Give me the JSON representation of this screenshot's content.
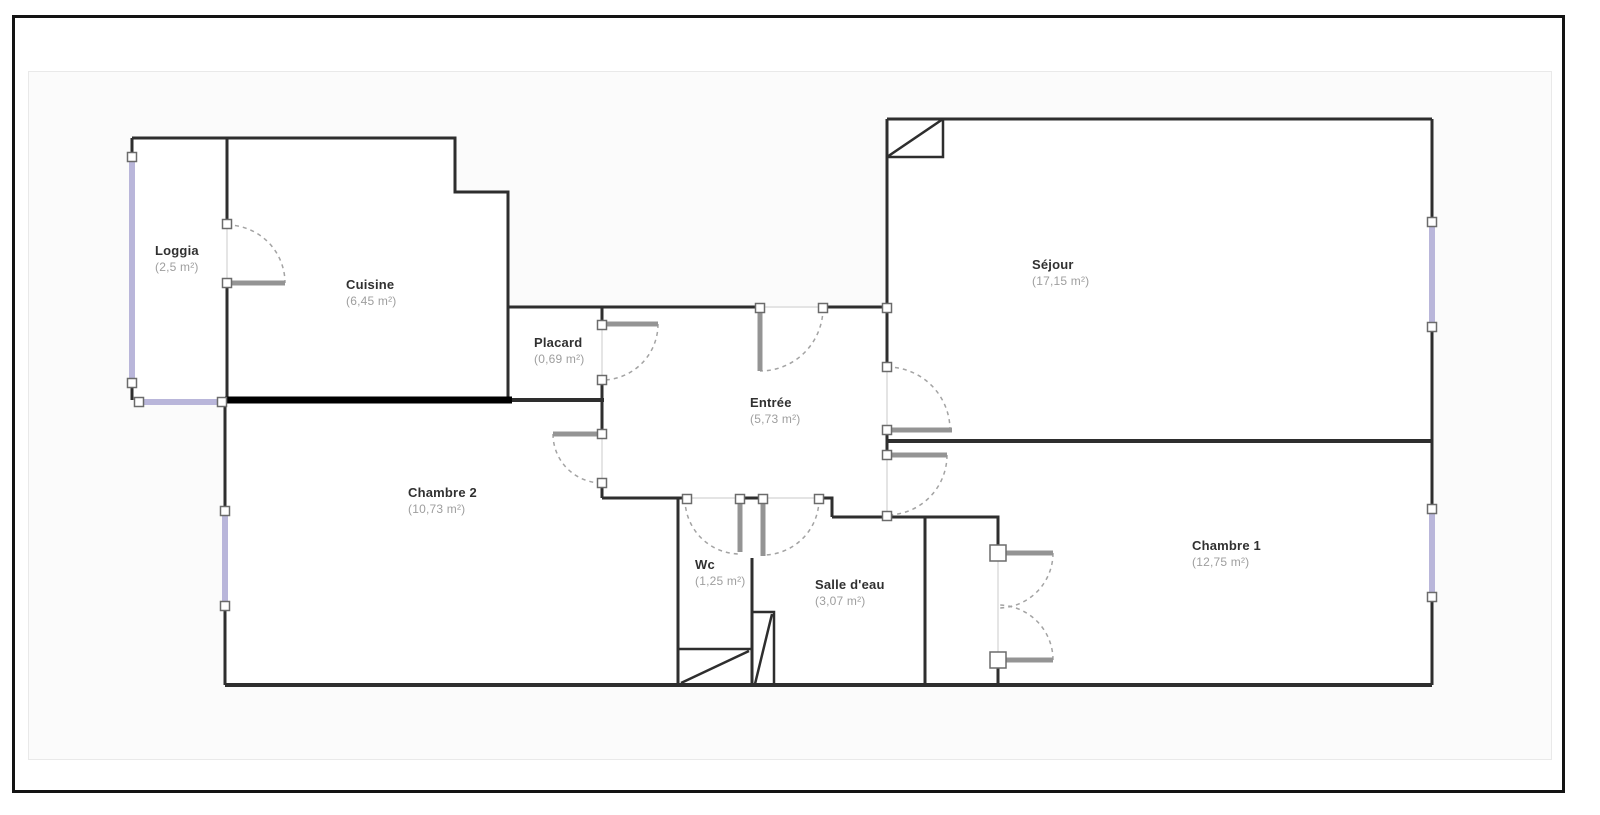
{
  "plan": {
    "rooms": {
      "loggia": {
        "name": "Loggia",
        "area": "(2,5 m²)"
      },
      "cuisine": {
        "name": "Cuisine",
        "area": "(6,45 m²)"
      },
      "placard": {
        "name": "Placard",
        "area": "(0,69 m²)"
      },
      "entree": {
        "name": "Entrée",
        "area": "(5,73 m²)"
      },
      "sejour": {
        "name": "Séjour",
        "area": "(17,15 m²)"
      },
      "chambre2": {
        "name": "Chambre 2",
        "area": "(10,73 m²)"
      },
      "wc": {
        "name": "Wc",
        "area": "(1,25 m²)"
      },
      "salle_deau": {
        "name": "Salle d'eau",
        "area": "(3,07 m²)"
      },
      "chambre1": {
        "name": "Chambre 1",
        "area": "(12,75 m²)"
      }
    },
    "colors": {
      "wall": "#2e2e2e",
      "facade_wall": "#000000",
      "door_leaf": "#949494",
      "swing_arc": "#a3a3a3",
      "window": "#b9b6da",
      "handle_border": "#6b6b6b"
    }
  }
}
